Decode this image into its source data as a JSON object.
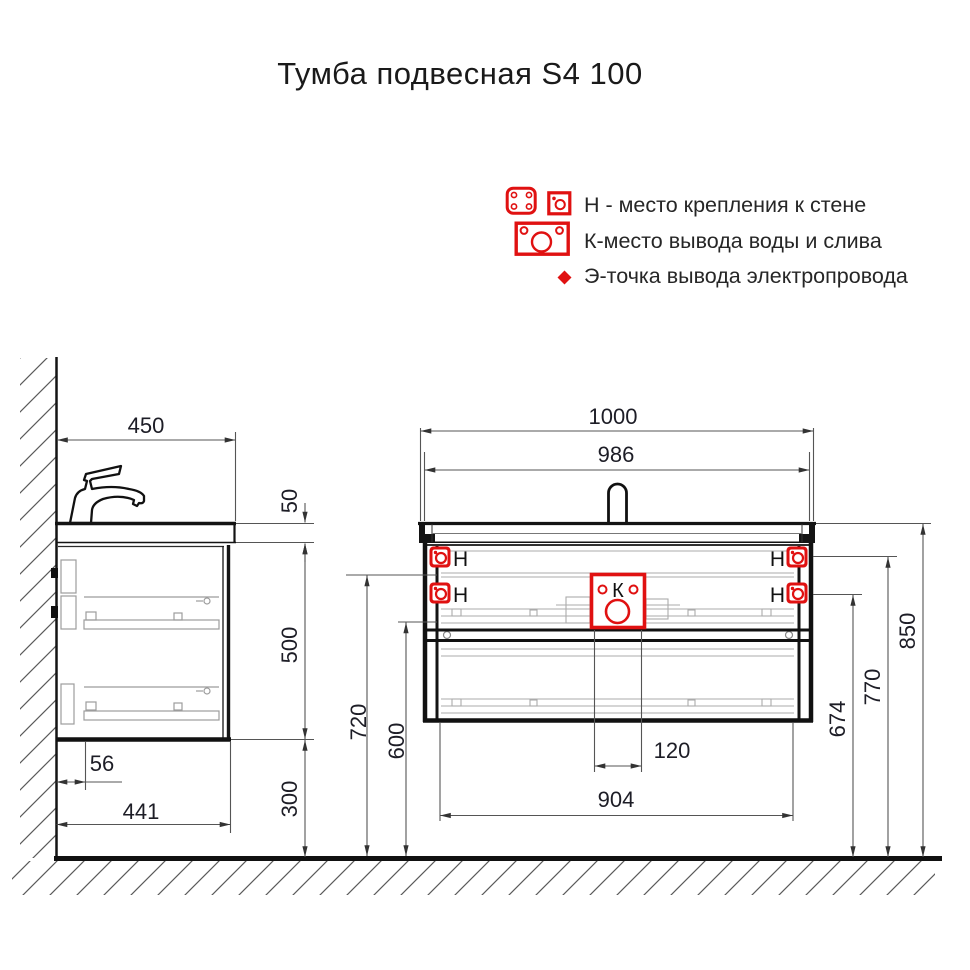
{
  "title": "Тумба подвесная S4 100",
  "legend": {
    "rows": [
      {
        "icon": "mount-plate-icon",
        "label": "Н - место крепления к стене"
      },
      {
        "icon": "water-drain-icon",
        "label": "К-место вывода воды и слива"
      },
      {
        "icon": "electric-point-icon",
        "label": "Э-точка вывода электропровода"
      }
    ]
  },
  "side_view": {
    "dims": {
      "depth_top": "450",
      "countertop_thickness": "50",
      "cabinet_height": "500",
      "back_offset": "56",
      "depth_bottom": "441",
      "floor_clearance": "300"
    }
  },
  "front_view": {
    "labels": {
      "mount": "Н",
      "water": "К"
    },
    "dims": {
      "total_width": "1000",
      "basin_width": "986",
      "mount_rail_height": "720",
      "drawer_top_height": "600",
      "drain_zone_width": "120",
      "mount_span": "904",
      "mount_lower_height": "674",
      "mount_upper_height": "770",
      "countertop_height": "850"
    }
  },
  "colors": {
    "accent_red": "#e01111",
    "line_black": "#141414",
    "detail_gray": "#9c9c9c"
  }
}
